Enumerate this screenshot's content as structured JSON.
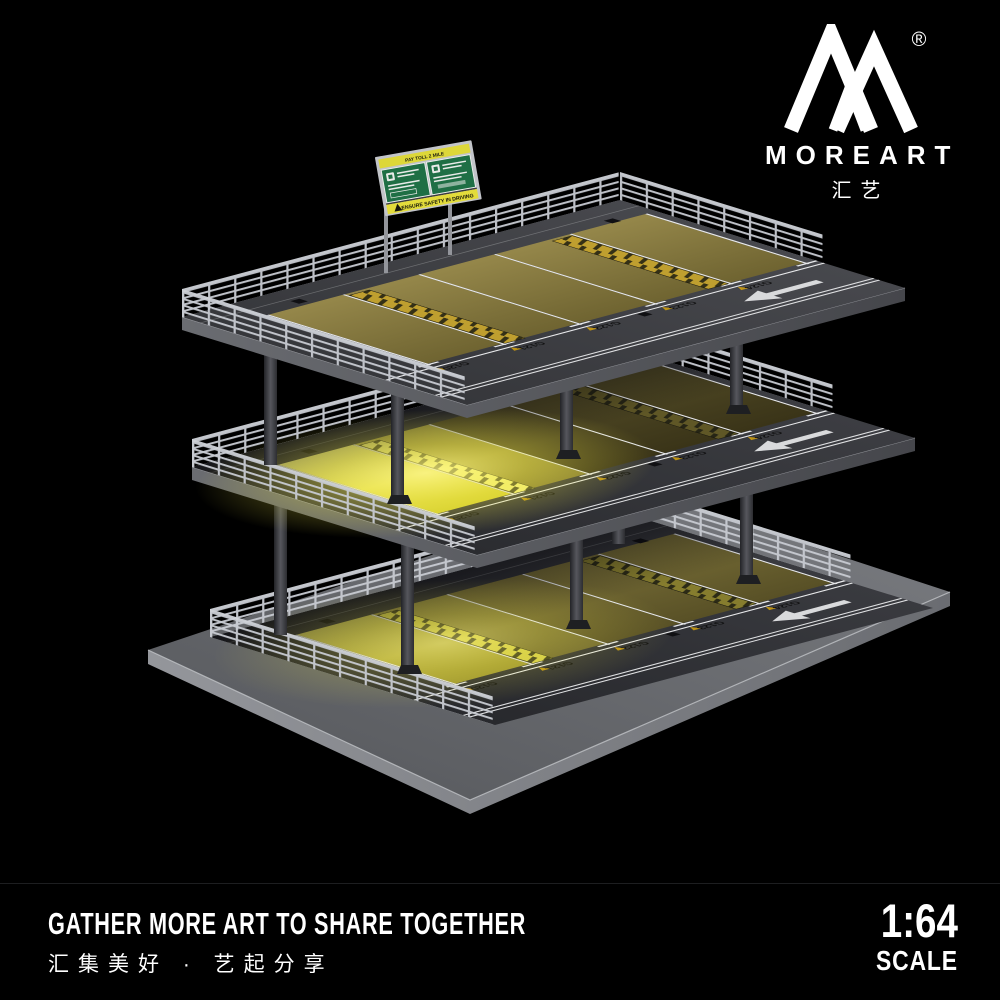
{
  "brand": {
    "name": "MOREART",
    "sub": "汇艺",
    "registered": "®"
  },
  "billboard": {
    "top_strip": "PAY TOLL 2 MILE",
    "warning_strip": "ENSURE SAFETY IN DRIVING"
  },
  "parking": {
    "levels": "3",
    "spot_labels": [
      "G120",
      "G121",
      "G122",
      "G123",
      "G124"
    ],
    "lane_arrow_direction": "left"
  },
  "footer": {
    "tagline_en": "GATHER MORE ART TO SHARE TOGETHER",
    "tagline_zh": "汇集美好 · 艺起分享",
    "scale_ratio": "1:64",
    "scale_label": "SCALE"
  },
  "colors": {
    "background": "#000000",
    "railing_silver": "#c8cbd2",
    "asphalt_gray": "#3a3b40",
    "parking_olive": "#8a7d3e",
    "led_glow_yellow": "#f2ee6e",
    "sign_green": "#1f6f45",
    "sign_yellow": "#ddd739",
    "text_white": "#ffffff"
  }
}
